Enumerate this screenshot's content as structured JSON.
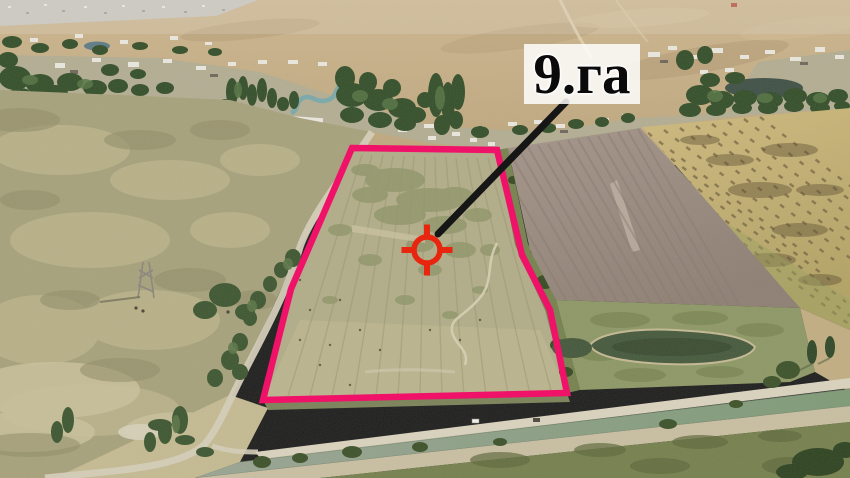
{
  "annotation": {
    "area_label": "9.га",
    "outline_color": "#ef1268",
    "marker_color": "#e8250f",
    "leader_color": "#161616",
    "label_background": "rgba(255,255,255,0.84)",
    "label_text_color": "#0a0a0a"
  }
}
